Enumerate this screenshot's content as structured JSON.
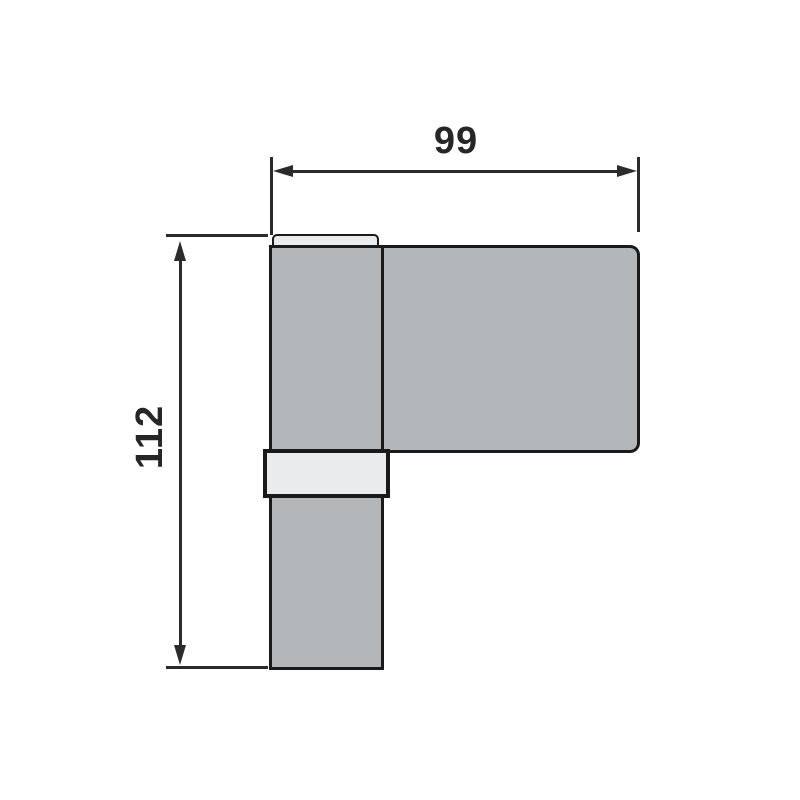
{
  "drawing": {
    "kind": "technical-dimension-drawing",
    "subject": "door-hinge-side-view",
    "dimensions": {
      "width": "99",
      "height": "112"
    },
    "colors": {
      "background": "#ffffff",
      "metal_fill": "#b4b7ba",
      "highlight_fill": "#e9ebec",
      "outline": "#1a1a1a",
      "dimension_line": "#2b2b2b",
      "text": "#262626"
    }
  }
}
